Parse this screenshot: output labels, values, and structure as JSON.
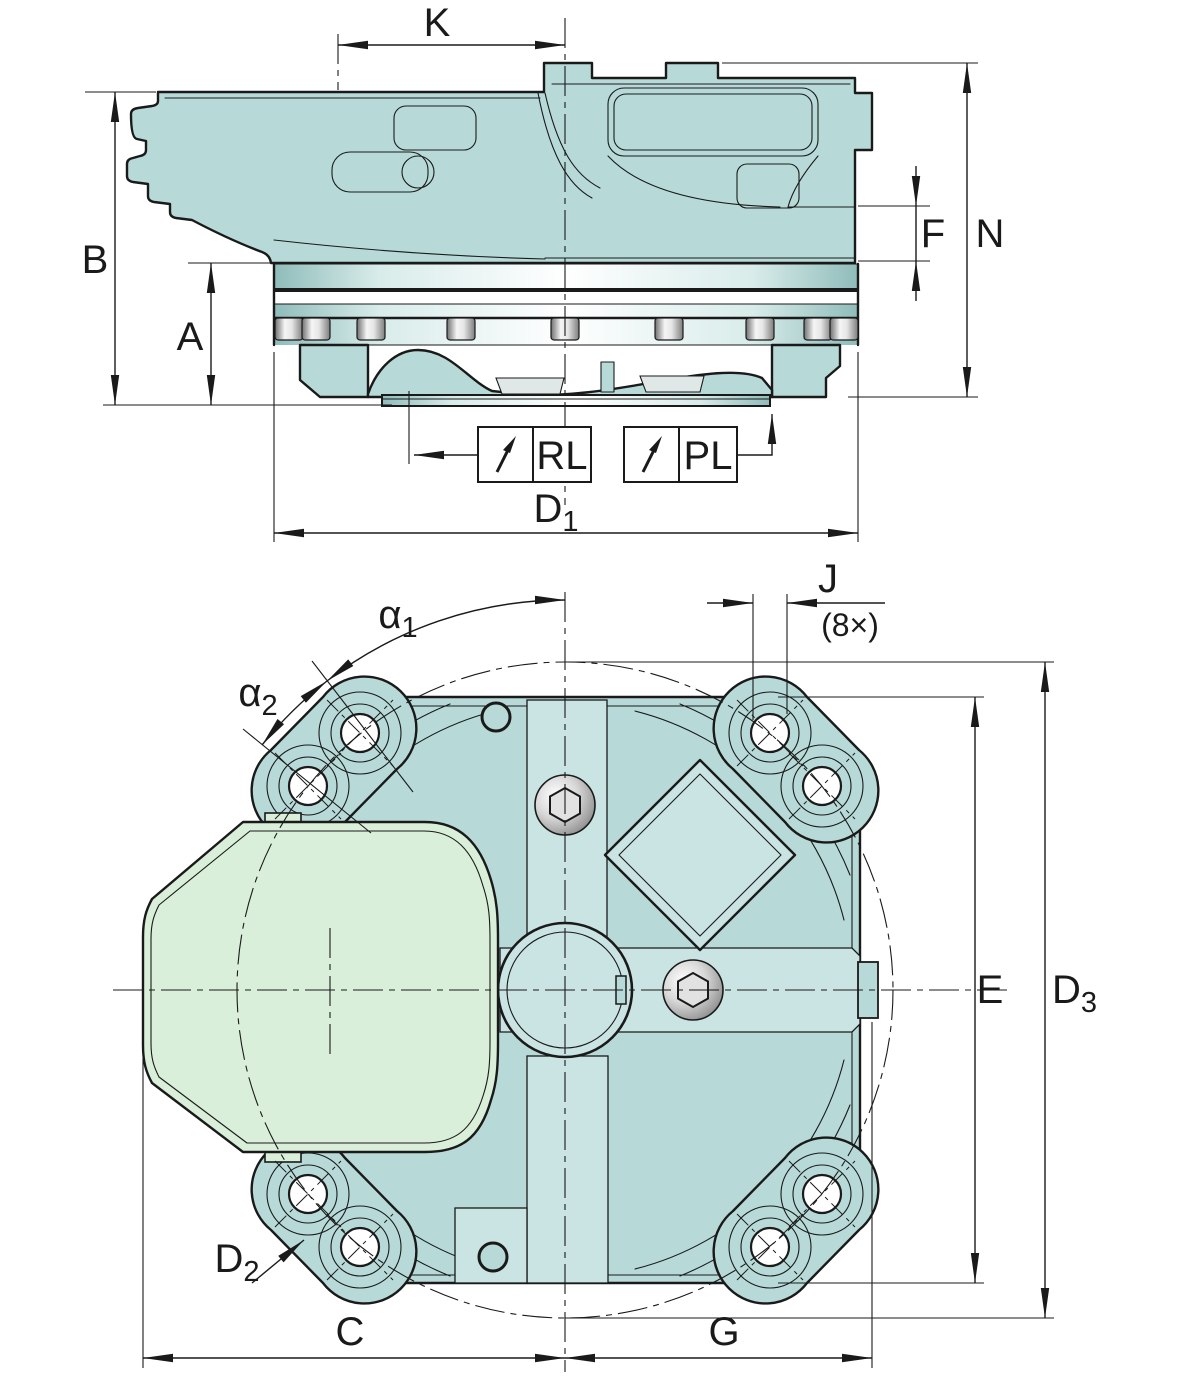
{
  "colors": {
    "line": "#1a1a1a",
    "body": "#b7dad8",
    "body_dark": "#a6cbc9",
    "body_light": "#c9e4e2",
    "green_cover": "#d9efd9",
    "band_edge": "#8fbcba",
    "metal_dark": "#7c7c7c",
    "metal_light": "#f5f5f5",
    "background": "#ffffff"
  },
  "side_view": {
    "dim_K": "K",
    "dim_B": "B",
    "dim_A": "A",
    "dim_F": "F",
    "dim_N": "N",
    "dim_D1": {
      "base": "D",
      "sub": "1"
    },
    "port_RL": "RL",
    "port_PL": "PL"
  },
  "front_view": {
    "dim_alpha1": {
      "base": "α",
      "sub": "1"
    },
    "dim_alpha2": {
      "base": "α",
      "sub": "2"
    },
    "dim_J": "J",
    "dim_J_count": "(8×)",
    "dim_E": "E",
    "dim_D3": {
      "base": "D",
      "sub": "3"
    },
    "dim_C": "C",
    "dim_G": "G",
    "dim_D2": {
      "base": "D",
      "sub": "2"
    }
  }
}
